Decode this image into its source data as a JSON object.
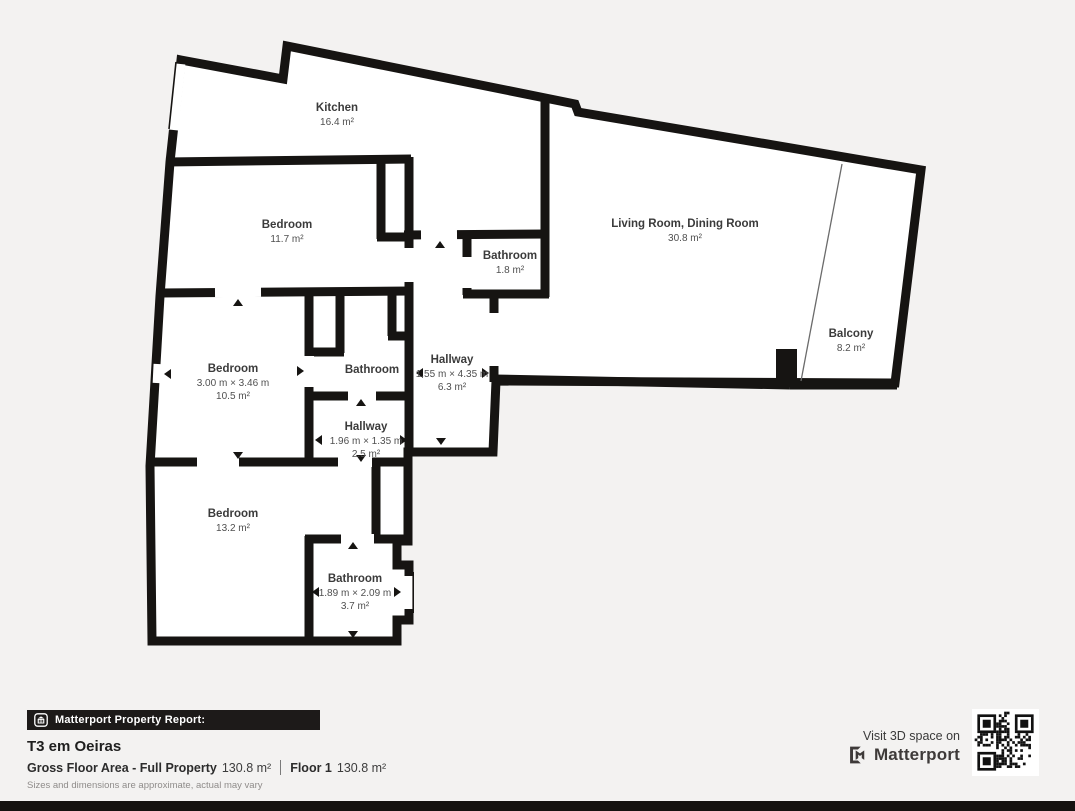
{
  "colors": {
    "background": "#f3f2f1",
    "wall": "#161412",
    "floor": "#ffffff",
    "footer_bar": "#1d1a19"
  },
  "rooms": {
    "kitchen": {
      "name": "Kitchen",
      "area": "16.4 m²"
    },
    "bedroom_top": {
      "name": "Bedroom",
      "area": "11.7 m²"
    },
    "bathroom_small": {
      "name": "Bathroom",
      "area": "1.8 m²"
    },
    "living": {
      "name": "Living Room, Dining Room",
      "area": "30.8 m²"
    },
    "balcony": {
      "name": "Balcony",
      "area": "8.2 m²"
    },
    "hallway_main": {
      "name": "Hallway",
      "dims": "1.55 m × 4.35 m",
      "area": "6.3 m²"
    },
    "bedroom_mid": {
      "name": "Bedroom",
      "dims": "3.00 m × 3.46 m",
      "area": "10.5 m²"
    },
    "bathroom_mid": {
      "name": "Bathroom"
    },
    "hallway_small": {
      "name": "Hallway",
      "dims": "1.96 m × 1.35 m",
      "area": "2.5 m²"
    },
    "bedroom_bottom": {
      "name": "Bedroom",
      "area": "13.2 m²"
    },
    "bathroom_bottom": {
      "name": "Bathroom",
      "dims": "1.89 m × 2.09 m",
      "area": "3.7 m²"
    }
  },
  "footer": {
    "report_label": "Matterport Property Report:",
    "title": "T3 em Oeiras",
    "gross_label": "Gross Floor Area - Full Property",
    "gross_value": "130.8 m²",
    "floor_label": "Floor 1",
    "floor_value": "130.8 m²",
    "disclaimer": "Sizes and dimensions are approximate, actual may vary",
    "visit_label": "Visit 3D space on",
    "brand": "Matterport"
  }
}
